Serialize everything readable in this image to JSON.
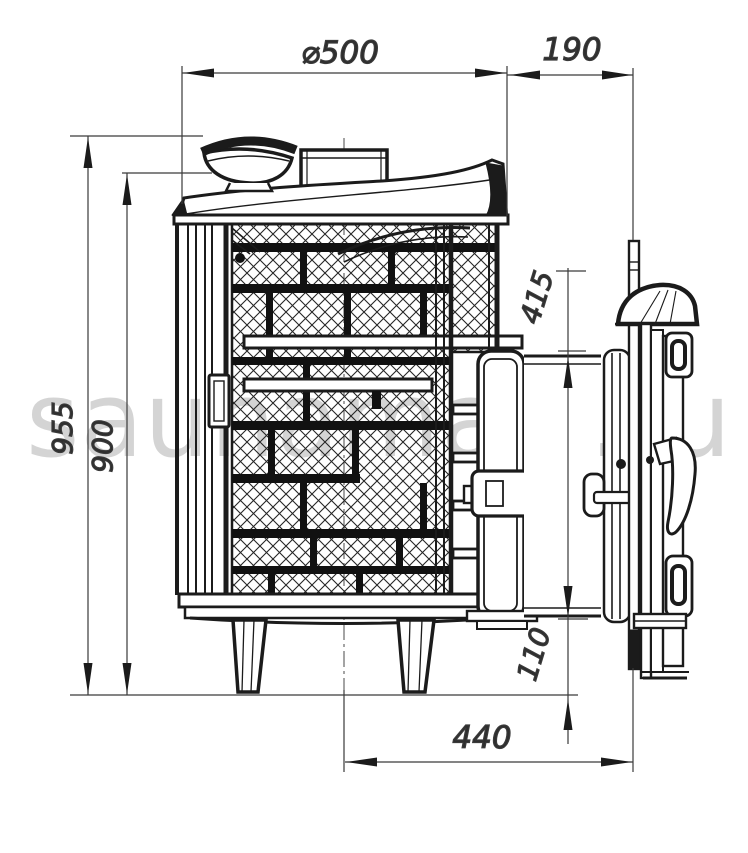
{
  "drawing": {
    "title": "sauna-stove-side-view-technical-drawing",
    "watermark": "saunamart.ru",
    "dims": {
      "diameter": "⌀500",
      "tunnel_length": "190",
      "height_total": "955",
      "height_body": "900",
      "tunnel_height": "415",
      "tunnel_bottom_offset": "110",
      "axis_to_door_flange": "440"
    },
    "colors": {
      "line": "#1b1b1b",
      "dim_line": "#3a3a3a",
      "watermark": "#c6c6c6",
      "background": "#ffffff"
    }
  }
}
